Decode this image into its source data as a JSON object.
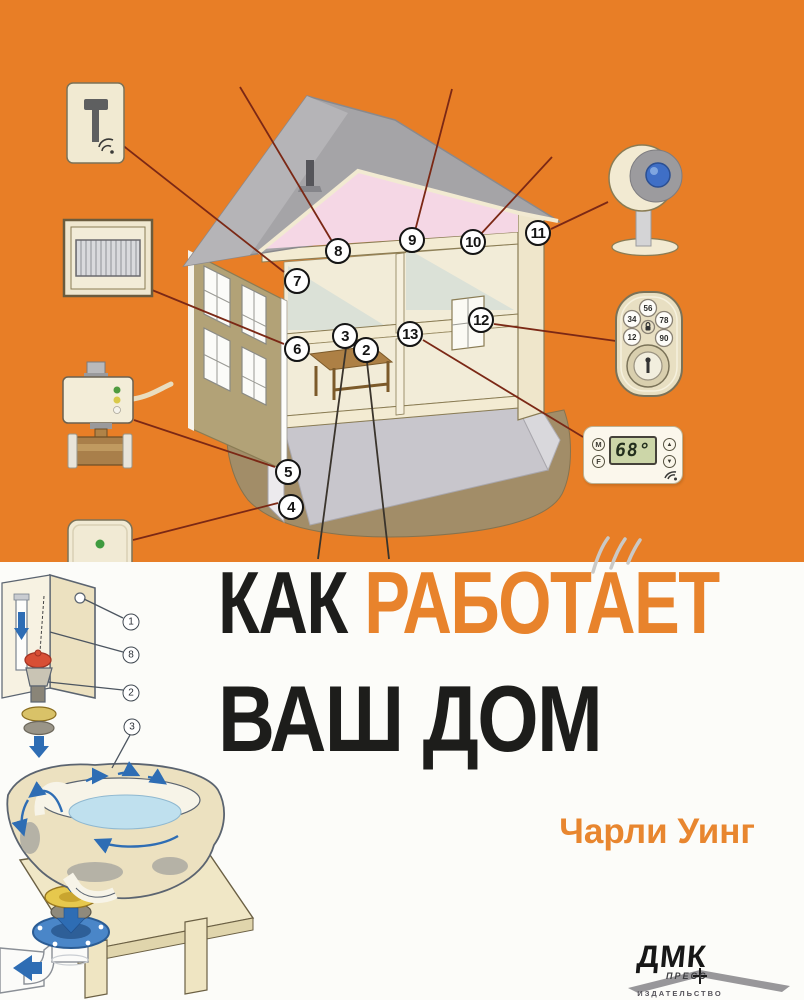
{
  "cover": {
    "bg_color": "#e87e26",
    "title": {
      "word1": "КАК",
      "word2": "РАБОТАЕТ",
      "line2": "ВАШ ДОМ",
      "word1_color": "#1d1d1b",
      "word2_color": "#e8832c"
    },
    "author": "Чарли Уинг"
  },
  "publisher": {
    "name": "ДМК",
    "press": "ПРЕСС",
    "subtitle": "ИЗДАТЕЛЬСТВО"
  },
  "house_callouts": [
    {
      "n": "2",
      "x": 366,
      "y": 350
    },
    {
      "n": "3",
      "x": 345,
      "y": 336
    },
    {
      "n": "4",
      "x": 291,
      "y": 507
    },
    {
      "n": "5",
      "x": 288,
      "y": 472
    },
    {
      "n": "6",
      "x": 297,
      "y": 349
    },
    {
      "n": "7",
      "x": 297,
      "y": 281
    },
    {
      "n": "8",
      "x": 338,
      "y": 251
    },
    {
      "n": "9",
      "x": 412,
      "y": 240
    },
    {
      "n": "10",
      "x": 473,
      "y": 242
    },
    {
      "n": "11",
      "x": 538,
      "y": 233
    },
    {
      "n": "12",
      "x": 481,
      "y": 320
    },
    {
      "n": "13",
      "x": 410,
      "y": 334
    }
  ],
  "toilet_callouts": [
    {
      "n": "1",
      "x": 131,
      "y": 622
    },
    {
      "n": "8",
      "x": 131,
      "y": 655
    },
    {
      "n": "2",
      "x": 131,
      "y": 693
    },
    {
      "n": "3",
      "x": 132,
      "y": 727
    }
  ],
  "devices": {
    "thermostat": {
      "display": "68°",
      "btn_mode": "M",
      "btn_fan": "F",
      "btn_up": "▲",
      "btn_down": "▼"
    },
    "lock_keys": [
      "56",
      "34",
      "78",
      "12",
      "90"
    ],
    "icon_names": [
      "smart-switch-icon",
      "air-filter-icon",
      "water-shutoff-valve-icon",
      "leak-sensor-icon",
      "security-camera-icon",
      "smart-lock-icon",
      "thermostat-icon",
      "wifi-icon"
    ]
  }
}
